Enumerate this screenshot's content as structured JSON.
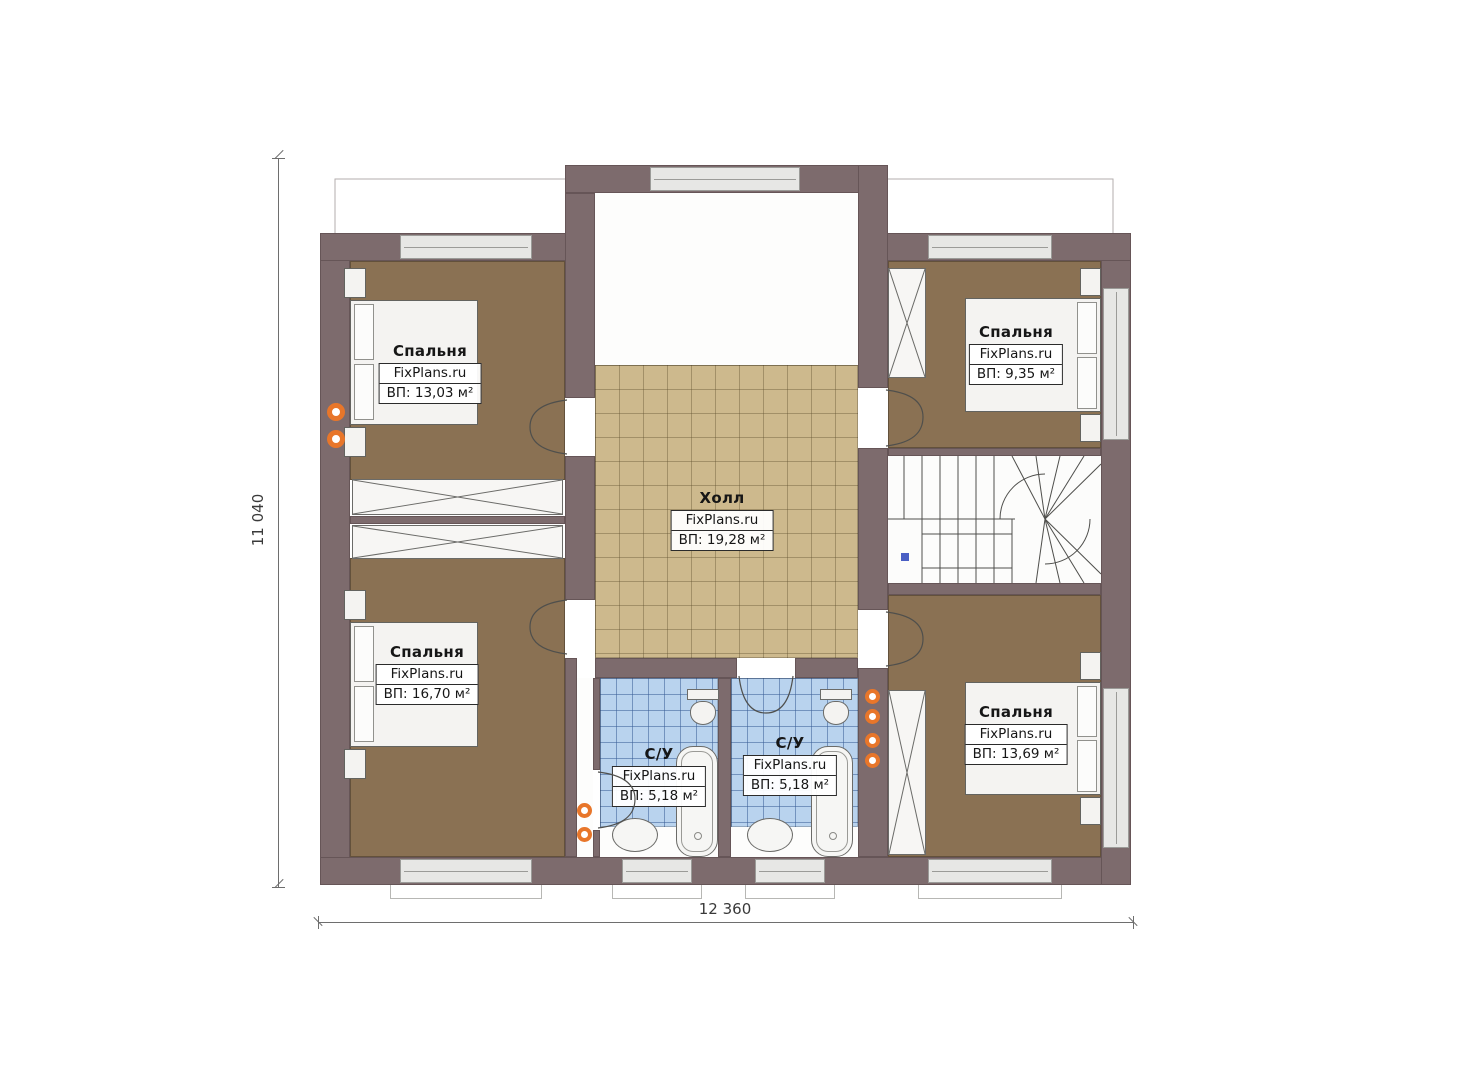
{
  "brand_watermark": "FixPlans.ru",
  "rooms": [
    {
      "id": "bedroom-1",
      "name": "Спальня",
      "brand": "FixPlans.ru",
      "area": "ВП: 13,03 м²"
    },
    {
      "id": "bedroom-2",
      "name": "Спальня",
      "brand": "FixPlans.ru",
      "area": "ВП: 9,35 м²"
    },
    {
      "id": "hall",
      "name": "Холл",
      "brand": "FixPlans.ru",
      "area": "ВП: 19,28 м²"
    },
    {
      "id": "bedroom-3",
      "name": "Спальня",
      "brand": "FixPlans.ru",
      "area": "ВП: 16,70 м²"
    },
    {
      "id": "bathroom-1",
      "name": "С/У",
      "brand": "FixPlans.ru",
      "area": "ВП: 5,18 м²"
    },
    {
      "id": "bathroom-2",
      "name": "С/У",
      "brand": "FixPlans.ru",
      "area": "ВП: 5,18 м²"
    },
    {
      "id": "bedroom-4",
      "name": "Спальня",
      "brand": "FixPlans.ru",
      "area": "ВП: 13,69 м²"
    }
  ],
  "dimensions": {
    "horizontal": "12 360",
    "vertical": "11 040"
  },
  "colors": {
    "wall": "#7d6b6d",
    "bedroom_floor": "#8a7153",
    "hall_tile": "#cdb98d",
    "bath_tile": "#b9d3ee",
    "accent_orange": "#e8762a",
    "marker_blue": "#4a5fc4"
  }
}
